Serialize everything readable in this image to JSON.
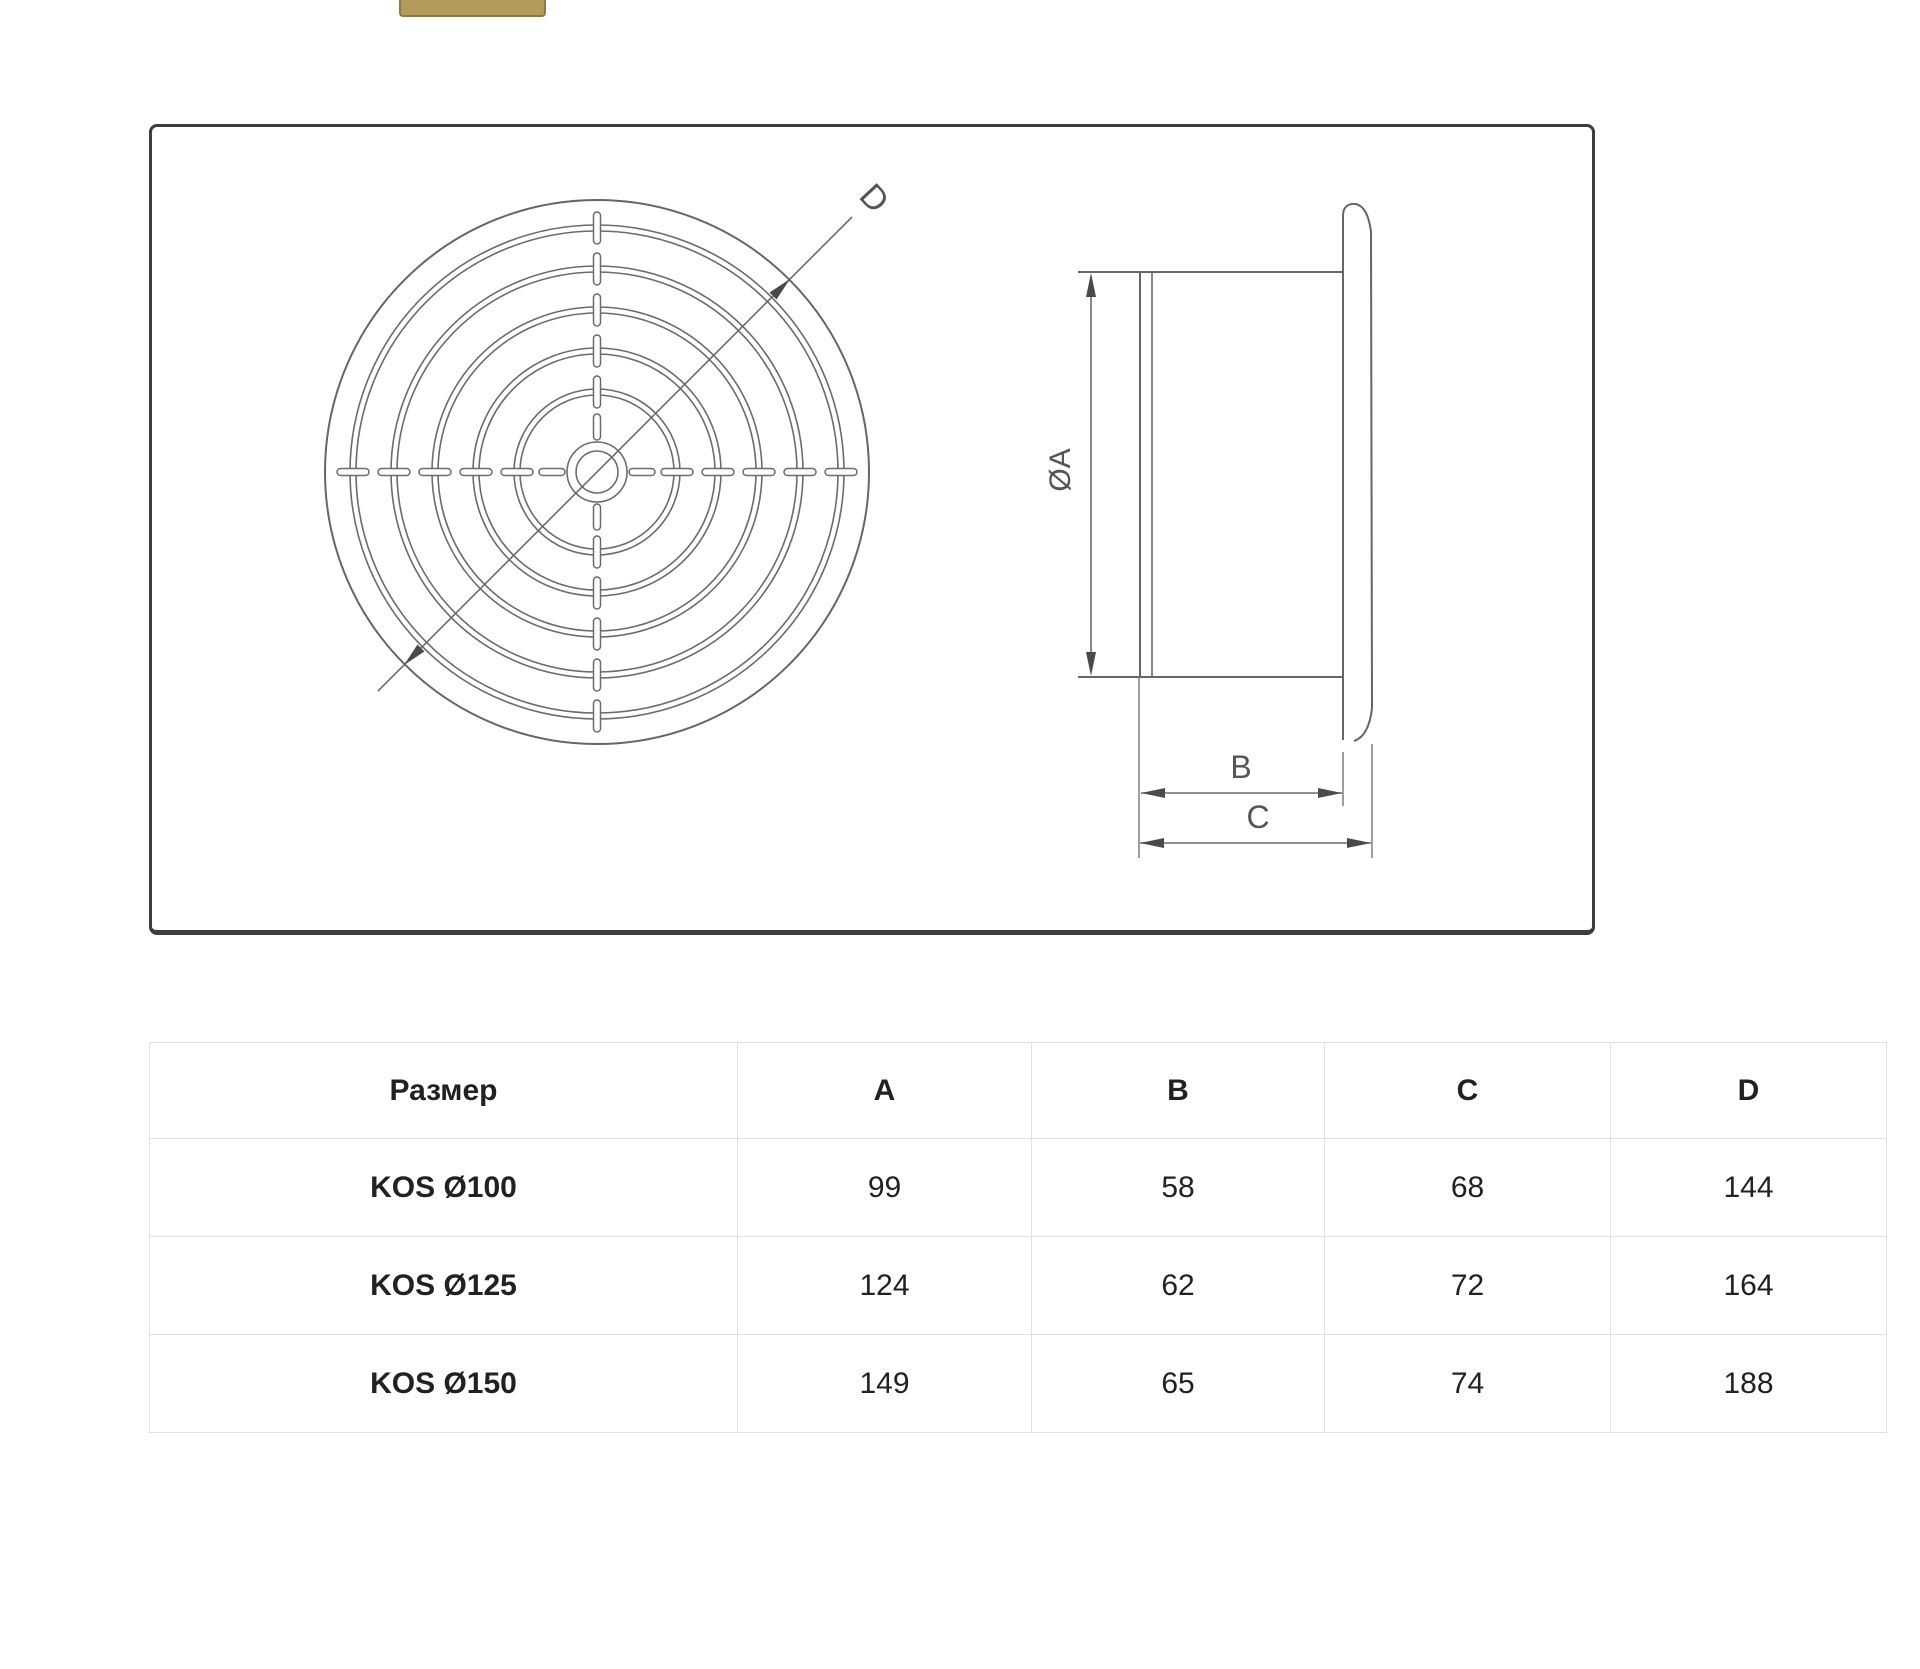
{
  "top_button": {
    "color": "#b29b5c",
    "border_color": "#8d7943"
  },
  "drawing": {
    "frame_border_color": "#3d3d3d",
    "line_color": "#666666",
    "labels": {
      "front_diameter": "D",
      "side_diameter": "ØA",
      "inner_depth": "B",
      "outer_depth": "C"
    }
  },
  "table": {
    "grid_color": "#e0e0e0",
    "text_color": "#212121",
    "headers": [
      "Размер",
      "A",
      "B",
      "C",
      "D"
    ],
    "rows": [
      {
        "label": "KOS Ø100",
        "values": [
          "99",
          "58",
          "68",
          "144"
        ]
      },
      {
        "label": "KOS Ø125",
        "values": [
          "124",
          "62",
          "72",
          "164"
        ]
      },
      {
        "label": "KOS Ø150",
        "values": [
          "149",
          "65",
          "74",
          "188"
        ]
      }
    ]
  }
}
